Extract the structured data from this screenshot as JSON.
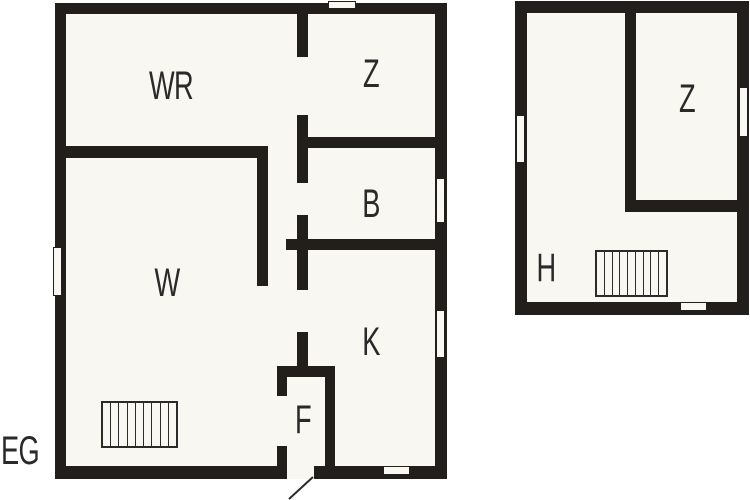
{
  "colors": {
    "wall": "#211e1c",
    "floor": "#f8f7f2",
    "background": "#ffffff",
    "label": "#2a2a2a"
  },
  "floor_plan": {
    "floor_tag": {
      "text": "EG",
      "cx": 20,
      "cy": 451
    },
    "labels": [
      {
        "name": "room-label-wr",
        "text": "WR",
        "cx": 171,
        "cy": 86
      },
      {
        "name": "room-label-z-eg",
        "text": "Z",
        "cx": 371,
        "cy": 74
      },
      {
        "name": "room-label-b",
        "text": "B",
        "cx": 371,
        "cy": 204
      },
      {
        "name": "room-label-w",
        "text": "W",
        "cx": 167,
        "cy": 283
      },
      {
        "name": "room-label-k",
        "text": "K",
        "cx": 371,
        "cy": 342
      },
      {
        "name": "room-label-f",
        "text": "F",
        "cx": 303,
        "cy": 420
      },
      {
        "name": "room-label-z-og",
        "text": "Z",
        "cx": 687,
        "cy": 99
      },
      {
        "name": "room-label-h",
        "text": "H",
        "cx": 546,
        "cy": 268
      }
    ],
    "floors": [
      {
        "name": "ground-floor-slab",
        "x": 55,
        "y": 3,
        "w": 392,
        "h": 476
      },
      {
        "name": "upper-floor-slab",
        "x": 515,
        "y": 1,
        "w": 234,
        "h": 314
      }
    ],
    "walls": [
      {
        "name": "eg-outer-top",
        "x": 55,
        "y": 3,
        "w": 392,
        "h": 11
      },
      {
        "name": "eg-outer-bottom",
        "x": 55,
        "y": 466,
        "w": 392,
        "h": 13
      },
      {
        "name": "eg-outer-left",
        "x": 55,
        "y": 3,
        "w": 11,
        "h": 476
      },
      {
        "name": "eg-outer-right",
        "x": 435,
        "y": 3,
        "w": 12,
        "h": 476
      },
      {
        "name": "eg-wr-bottom-wall",
        "x": 55,
        "y": 146,
        "w": 213,
        "h": 12
      },
      {
        "name": "eg-w-right-wall",
        "x": 257,
        "y": 146,
        "w": 11,
        "h": 140
      },
      {
        "name": "eg-hall-wall-a",
        "x": 297,
        "y": 14,
        "w": 11,
        "h": 43
      },
      {
        "name": "eg-hall-wall-b",
        "x": 297,
        "y": 115,
        "w": 11,
        "h": 68
      },
      {
        "name": "eg-hall-wall-c",
        "x": 297,
        "y": 215,
        "w": 11,
        "h": 75
      },
      {
        "name": "eg-hall-wall-d",
        "x": 297,
        "y": 332,
        "w": 11,
        "h": 35
      },
      {
        "name": "eg-z-b-divider",
        "x": 297,
        "y": 137,
        "w": 139,
        "h": 11
      },
      {
        "name": "eg-b-k-divider",
        "x": 286,
        "y": 239,
        "w": 150,
        "h": 11
      },
      {
        "name": "eg-f-top-wall",
        "x": 277,
        "y": 366,
        "w": 58,
        "h": 11
      },
      {
        "name": "eg-f-left-upper",
        "x": 277,
        "y": 377,
        "w": 10,
        "h": 19
      },
      {
        "name": "eg-f-left-lower",
        "x": 277,
        "y": 446,
        "w": 10,
        "h": 20
      },
      {
        "name": "eg-f-right-wall",
        "x": 325,
        "y": 377,
        "w": 10,
        "h": 89
      },
      {
        "name": "og-outer-top",
        "x": 515,
        "y": 1,
        "w": 234,
        "h": 12
      },
      {
        "name": "og-outer-bottom",
        "x": 515,
        "y": 302,
        "w": 234,
        "h": 13
      },
      {
        "name": "og-outer-left",
        "x": 515,
        "y": 1,
        "w": 12,
        "h": 314
      },
      {
        "name": "og-outer-right",
        "x": 737,
        "y": 1,
        "w": 12,
        "h": 314
      },
      {
        "name": "og-z-left-wall",
        "x": 625,
        "y": 13,
        "w": 11,
        "h": 199
      },
      {
        "name": "og-z-bottom-wall",
        "x": 625,
        "y": 200,
        "w": 112,
        "h": 12
      }
    ],
    "openings": [
      {
        "name": "eg-top-vent",
        "x": 328,
        "y": 1,
        "w": 28,
        "h": 8,
        "cut": false
      },
      {
        "name": "eg-left-window",
        "x": 53,
        "y": 247,
        "w": 9,
        "h": 49,
        "cut": false
      },
      {
        "name": "eg-right-window-b",
        "x": 436,
        "y": 178,
        "w": 9,
        "h": 45,
        "cut": false
      },
      {
        "name": "eg-right-window-k",
        "x": 436,
        "y": 310,
        "w": 9,
        "h": 48,
        "cut": false
      },
      {
        "name": "eg-bottom-window",
        "x": 383,
        "y": 466,
        "w": 27,
        "h": 9,
        "cut": false
      },
      {
        "name": "eg-entrance-door",
        "x": 287,
        "y": 464,
        "w": 27,
        "h": 15,
        "cut": true
      },
      {
        "name": "og-left-window",
        "x": 516,
        "y": 115,
        "w": 9,
        "h": 48,
        "cut": false
      },
      {
        "name": "og-right-window",
        "x": 739,
        "y": 87,
        "w": 9,
        "h": 50,
        "cut": false
      },
      {
        "name": "og-bottom-door",
        "x": 680,
        "y": 302,
        "w": 27,
        "h": 9,
        "cut": false
      }
    ],
    "stairs": [
      {
        "name": "eg-staircase",
        "x": 101,
        "y": 401,
        "w": 77,
        "h": 47,
        "steps": 9
      },
      {
        "name": "og-staircase",
        "x": 595,
        "y": 250,
        "w": 73,
        "h": 47,
        "steps": 9
      }
    ],
    "door_swing": {
      "x1": 313,
      "y1": 477,
      "x2": 289,
      "y2": 499
    }
  }
}
